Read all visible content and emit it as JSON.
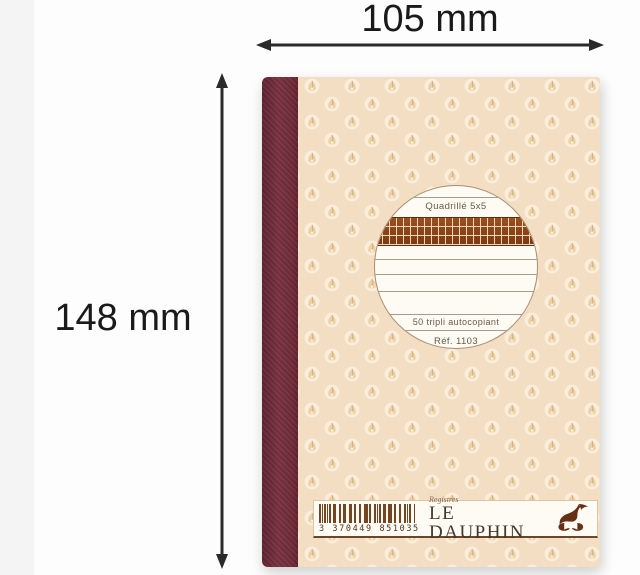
{
  "dimensions": {
    "width_label": "105 mm",
    "height_label": "148 mm"
  },
  "notebook": {
    "label_circle": {
      "grid_type": "Quadrillé 5x5",
      "sheets": "50 tripli autocopiant",
      "ref": "Réf. 1103"
    },
    "brand_strip": {
      "barcode_digits": "3 370449 851035",
      "series": "Registres",
      "brand": "LE DAUPHIN",
      "logo_icon": "dolphin-icon"
    },
    "colors": {
      "spine": "#6e2938",
      "cover": "#f3ddc3",
      "quadrille_band": "#8a4318",
      "barcode_brown": "#74451f",
      "brand_text": "#44382b",
      "annotation_text": "#1a1a1a"
    }
  }
}
